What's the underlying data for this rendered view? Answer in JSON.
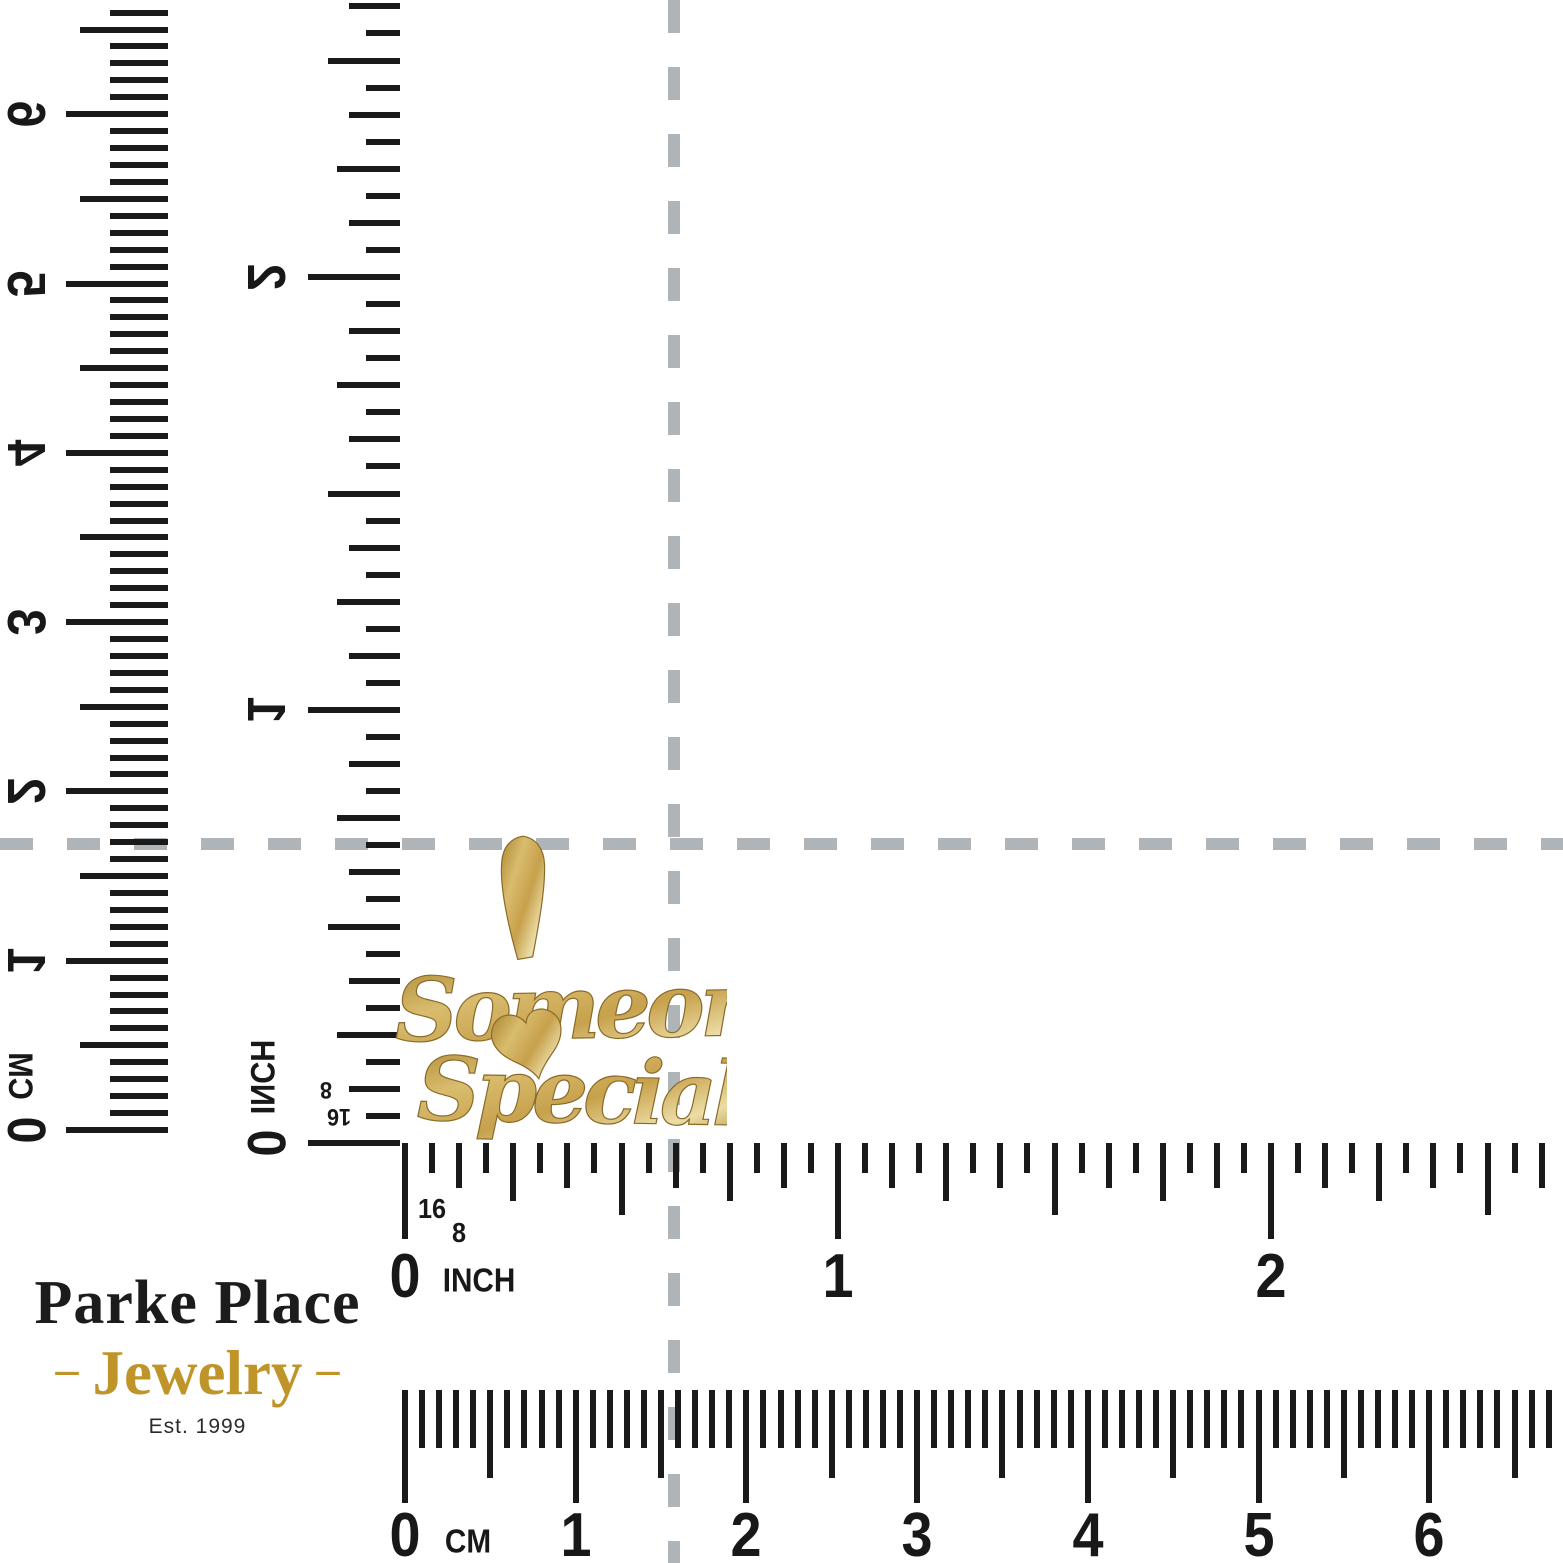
{
  "photo": {
    "description": "Gold pendant scale photo on white background",
    "background_color": "#ffffff"
  },
  "crosshair": {
    "color": "#aeb4b8"
  },
  "pendant": {
    "word1": "Someone",
    "word2": "Special",
    "heart_icon": "heart",
    "gold_base": "#c7a14c",
    "gold_light": "#ecdda6",
    "gold_dark": "#8a6a28"
  },
  "rulers": {
    "tick_color": "#1a1a1a",
    "vertical_cm": {
      "unit": "CM",
      "numbers": [
        "0",
        "1",
        "2",
        "3",
        "4",
        "5",
        "6"
      ]
    },
    "vertical_inch": {
      "unit": "INCH",
      "numbers": [
        "0",
        "1",
        "2"
      ],
      "fraction_8": "8",
      "fraction_16": "16"
    },
    "horizontal_inch": {
      "unit": "INCH",
      "numbers": [
        "0",
        "1",
        "2"
      ],
      "fraction_16": "16",
      "fraction_8": "8"
    },
    "horizontal_cm": {
      "unit": "CM",
      "numbers": [
        "0",
        "1",
        "2",
        "3",
        "4",
        "5",
        "6"
      ]
    }
  },
  "brand": {
    "name": "Parke Place",
    "sub_prefix": "–",
    "sub_word": "Jewelry",
    "sub_suffix": "–",
    "est": "Est. 1999",
    "name_color": "#1c1c1c",
    "gold_color": "#bf9428",
    "est_color": "#2b2b2b"
  }
}
